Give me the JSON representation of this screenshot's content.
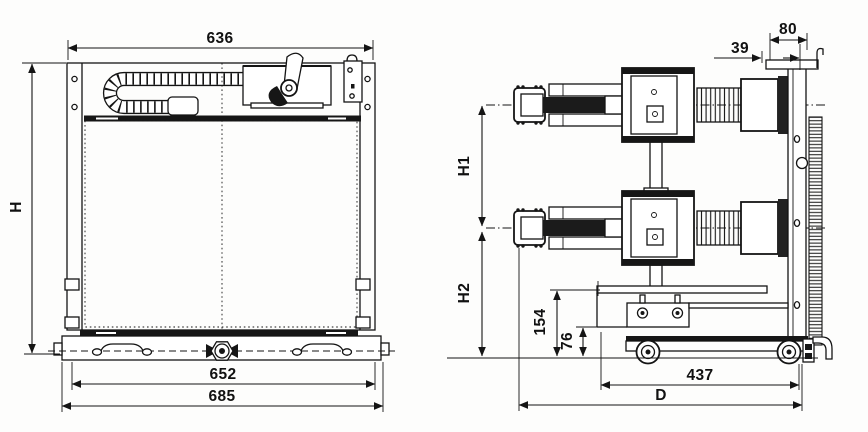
{
  "drawing": {
    "kind": "outline-dimension-drawing",
    "views": {
      "front": "front view",
      "side": "side view"
    },
    "line_color": "#141414",
    "background": "#fdfdfc"
  },
  "dimensions": {
    "front": {
      "top_width": "636",
      "height": "H",
      "base_inner_width": "652",
      "base_outer_width": "685"
    },
    "side": {
      "offset": "39",
      "panel_depth": "80",
      "upper_pole_height": "H1",
      "lower_pole_height": "H2",
      "bracket_height": "154",
      "step_height": "76",
      "truck_length": "437",
      "overall_depth": "D"
    }
  }
}
